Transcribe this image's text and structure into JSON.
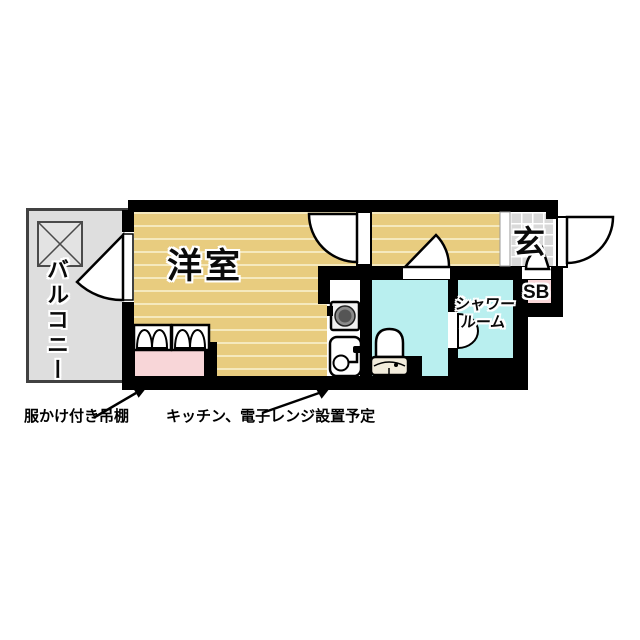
{
  "floorplan": {
    "rooms": {
      "main_room_label": "洋室",
      "balcony_label": "バルコニー",
      "entrance_label": "玄",
      "shower_room_label_line1": "シャワー",
      "shower_room_label_line2": "ルーム",
      "shoe_box_label": "SB"
    },
    "annotations": {
      "closet_note": "服かけ付き吊棚",
      "kitchen_note": "キッチン、電子レンジ設置予定"
    },
    "icons": {
      "balcony_hatch": "crossed-box-icon",
      "kitchen_stove": "stove-burner-icon",
      "kitchen_sink": "sink-faucet-icon",
      "toilet": "toilet-icon",
      "closet_hangers": "hanging-clothes-icon",
      "door_swings": "door-swing-arc-icon",
      "annotation_arrows": "arrow-icon"
    },
    "colors": {
      "flooring": "#E8CC7F",
      "flooring_stripe": "#F5E9BE",
      "wet_room_cyan": "#B9EFEF",
      "closet_pink": "#F8D6D8",
      "balcony_gray": "#DEDEDE",
      "entrance_tile": "#D9D9D9",
      "wall": "#000000"
    }
  }
}
